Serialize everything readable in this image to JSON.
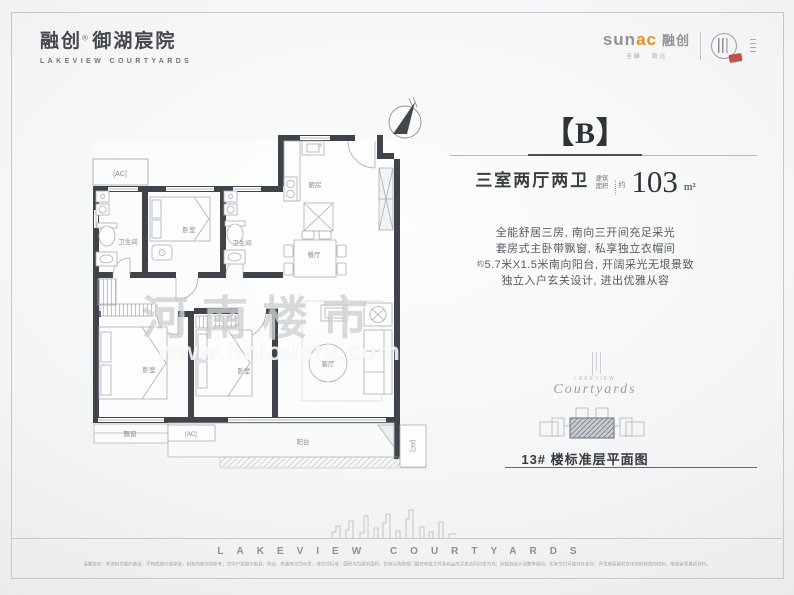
{
  "header": {
    "logo_cn": "融创",
    "logo_reg": "®",
    "logo_sub": "御湖宸院",
    "logo_en": "LAKEVIEW COURTYARDS",
    "sunac_sun": "sun",
    "sunac_ac": "ac",
    "sunac_cn": "融创",
    "sunac_slogan": "至臻 · 致远"
  },
  "panel": {
    "badge": "【B】",
    "layout_label": "三室两厅两卫",
    "area_word_top": "建筑",
    "area_word_bottom": "面积",
    "area_approx": "约",
    "area_value": "103",
    "area_unit": "m²",
    "desc_line1": "全能舒居三房, 南向三开间充足采光",
    "desc_line2": "套房式主卧带飘窗, 私享独立衣帽间",
    "desc_line3_prefix": "约",
    "desc_line3": "5.7米X1.5米南向阳台, 开阔采光无垠景致",
    "desc_line4": "独立入户玄关设计, 进出优雅从容",
    "script_small": "LAKEVIEW",
    "script_word": "Courtyards",
    "floor_caption": "13# 楼标准层平面图"
  },
  "plan": {
    "compass_n": "N",
    "rooms": {
      "bath1": "卫生间",
      "bed_top": "卧室",
      "bath2": "卫生间",
      "kitchen": "厨房",
      "dining": "餐厅",
      "living": "客厅",
      "bed_left": "卧室",
      "bed_mid": "卧室",
      "bay_window": "飘窗",
      "balcony": "阳台",
      "ac": "[AC]"
    },
    "watermark_cn": "河南楼市",
    "watermark_url": "www.hnloushi.com"
  },
  "footer": {
    "wordmark": "LAKEVIEW COURTYARDS",
    "disclaimer": "温馨提示：本资料为要约邀请，不构成要约或承诺，相关内容仅供参考；文中户型图中家具、陈设、布置等仅为示意，非交付标准；面积均为建筑面积，实际以政府部门最终审批文件及商品房买卖合同约定为准；因规划设计调整等原因，实际交付可能存在差异；开发商保留对宣传资料修改的权利，敬请留意最新资料。"
  },
  "colors": {
    "accent_orange": "#e98d22",
    "seal_red": "#b5352c",
    "wall": "#3f444a"
  }
}
